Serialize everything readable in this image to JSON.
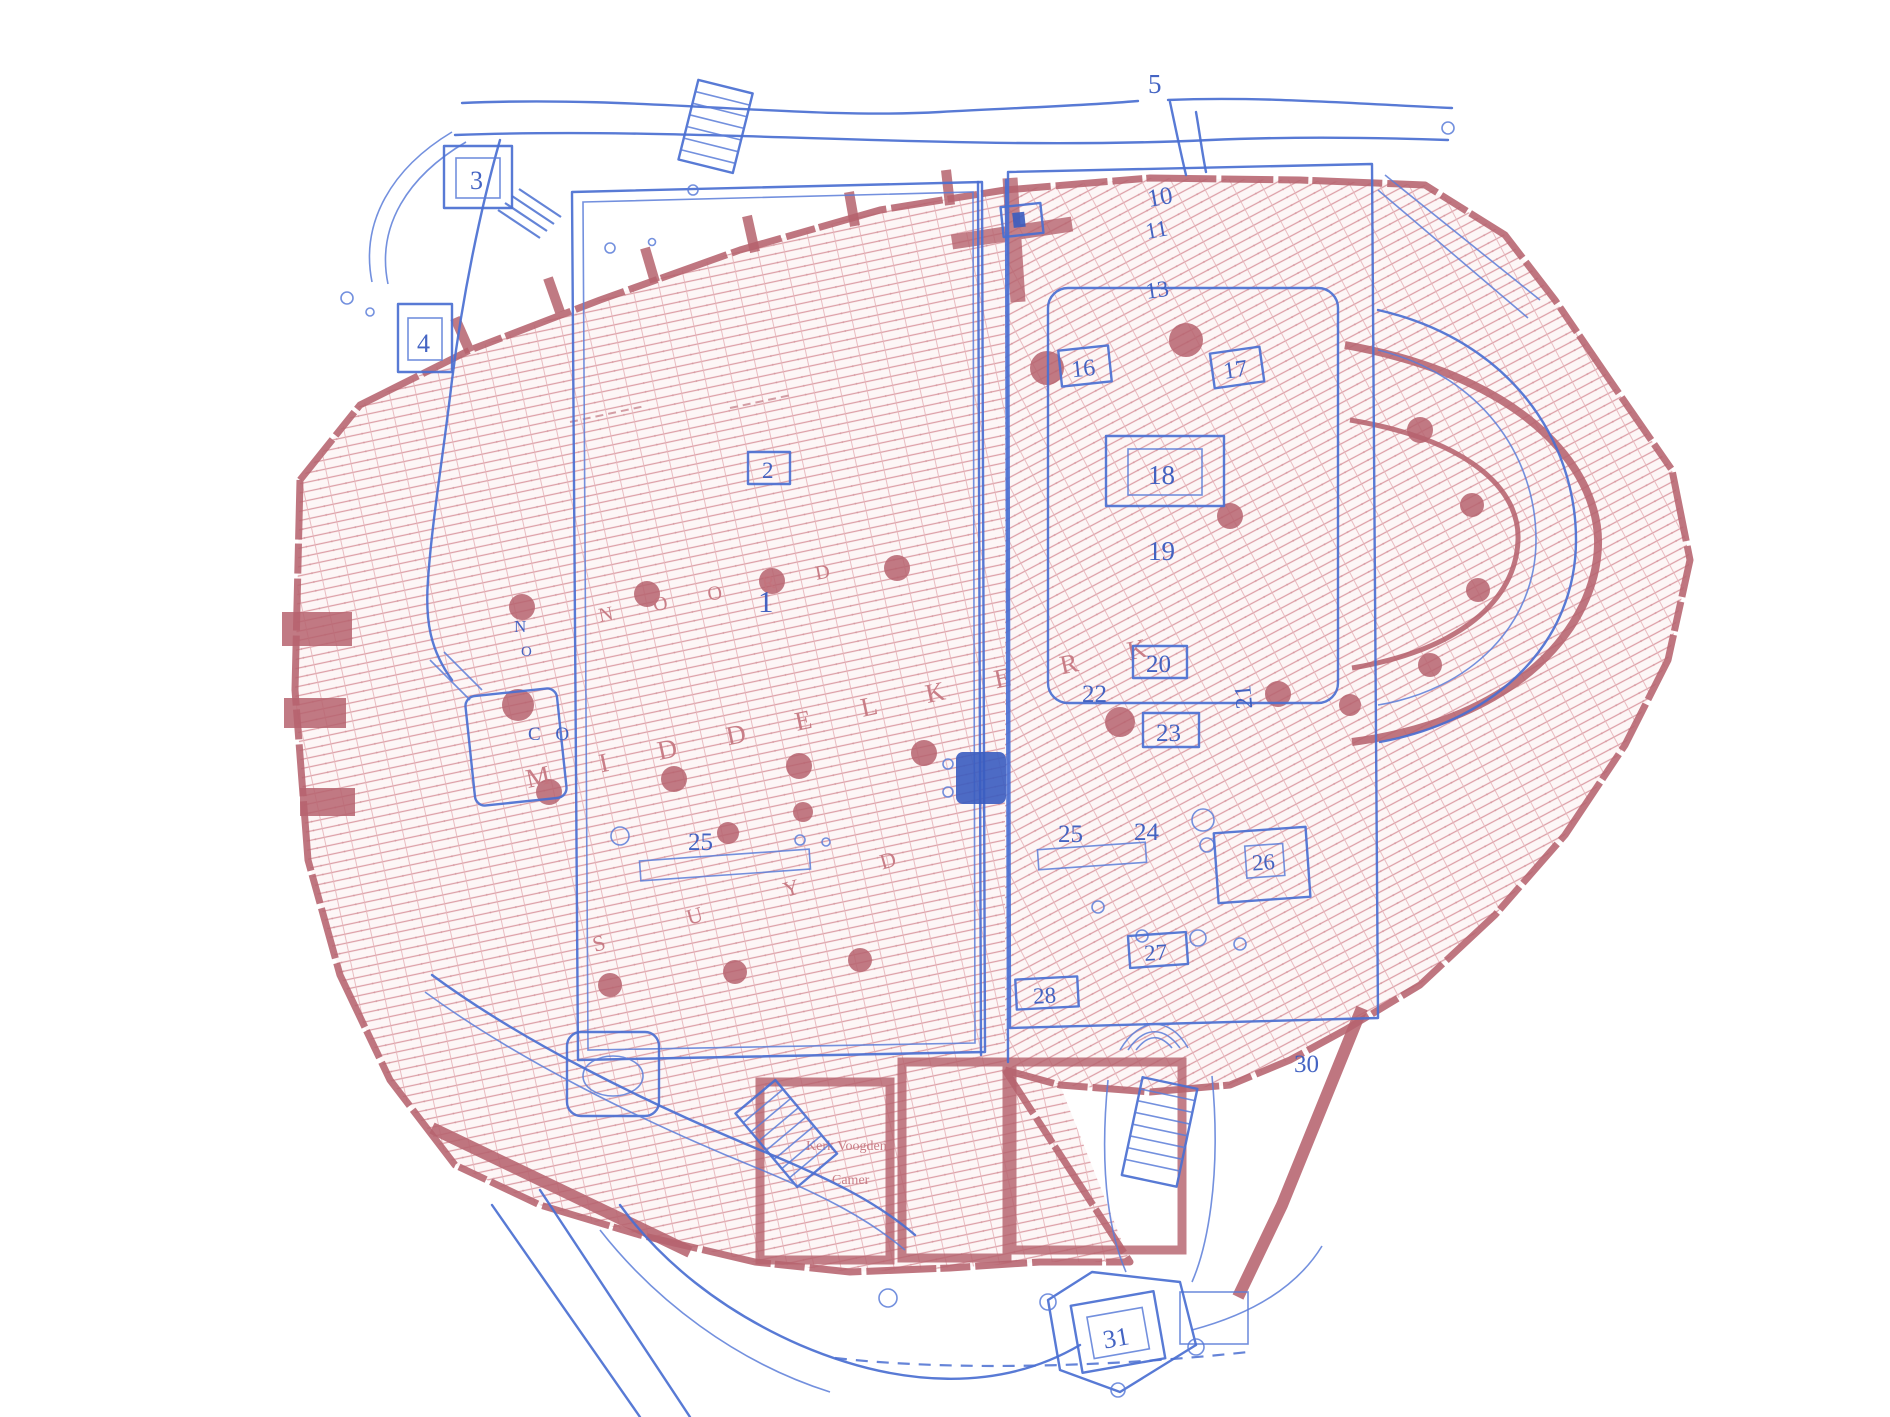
{
  "colors": {
    "blue_line": "#4a6fd1",
    "blue_text": "#3a5cc0",
    "red_hatch_line": "#d8939c",
    "red_wall": "#b6636e",
    "red_text": "#c4737d",
    "background": "#ffffff"
  },
  "blue_labels": {
    "n1": "1",
    "n2": "2",
    "n3": "3",
    "n4": "4",
    "n5": "5",
    "n10": "10",
    "n11": "11",
    "n13": "13",
    "n16": "16",
    "n17": "17",
    "n18": "18",
    "n19": "19",
    "n20": "20",
    "n21": "21",
    "n22": "22",
    "n23": "23",
    "n24": "24",
    "n25_left": "25",
    "n25_right": "25",
    "n26": "26",
    "n27": "27",
    "n28": "28",
    "n30": "30",
    "n31": "31",
    "letter_n": "N",
    "letter_o": "O",
    "letters_co": "C O"
  },
  "red_words": {
    "middelkerk": "M I D D E L K E R K",
    "noord": "N O O R D",
    "suyd": "S U Y D",
    "room_line1": "Kerk Voogden",
    "room_line2": "Camer"
  }
}
